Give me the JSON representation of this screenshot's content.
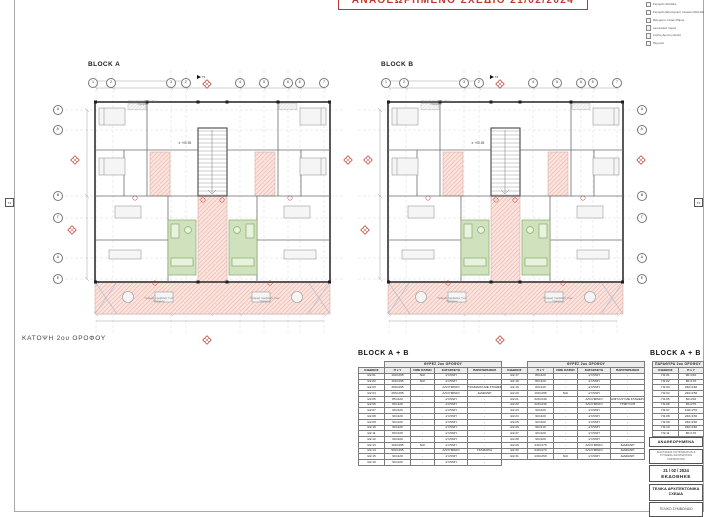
{
  "sheet": {
    "revision_banner": "ΑΝΑΘΕΩΡΗΜΕΝΟ ΣΧΕΔΙΟ 21/02/2024",
    "floor_plan_label": "ΚΑΤΟΨΗ 2ου ΟΡΟΦΟΥ"
  },
  "blocks": {
    "a": "BLOCK A",
    "b": "BLOCK B"
  },
  "legend": {
    "items": [
      "Κεραμίδι 40x40εκ.",
      "Κεραμίδι (Εξωτερικό) πλακάκι 60x120εκ.",
      "Μάρμαρο πλακέ 25ψηλ.",
      "Laminated παρκέ",
      "Ξύλινη Δρύινη (deck)",
      "Πέργολα"
    ]
  },
  "plan": {
    "top_bubbles": [
      "1",
      "2",
      "3",
      "2'",
      "4",
      "5",
      "6",
      "6'",
      "7"
    ],
    "row_bubbles": [
      "Α",
      "Α'",
      "Β",
      "Γ",
      "Δ",
      "Ε"
    ],
    "level_mark": "+05.55",
    "projection_note": "Γραμμή προβολής Των Ορόφων",
    "section_t1": "Τ1",
    "section_t2": "Τ2"
  },
  "doors_table": {
    "title": "BLOCK  A + B",
    "group_header": "ΘΥΡΕΣ 2ου ΟΡΟΦΟΥ",
    "columns": [
      "ΚΩΔΙΚΟΣ",
      "Π x Y",
      "FIRE RATED",
      "ΚΑΤΑΣΚΕΥΗ",
      "ΠΑΡΑΤΗΡΗΣΕΙΣ"
    ],
    "left_rows": [
      [
        "Θ2.01",
        "100×295",
        "ΝΑΙ",
        "ΞΥΛΙΝΗ",
        "-"
      ],
      [
        "Θ2.02",
        "100×295",
        "ΝΑΙ",
        "ΞΥΛΙΝΗ",
        "-"
      ],
      [
        "Θ2.03",
        "450×295",
        "-",
        "ΑΛΟΥΜΙΝΙΟ",
        "ΤΖΑΜΑΡΙΑ ΜΕ ΣΤΑΘΕΡΟ ΤΖΑΜΙ"
      ],
      [
        "Θ2.04",
        "250×295",
        "-",
        "ΑΛΟΥΜΙΝΙΟ",
        "ΔΙΑΦΑΝΗ"
      ],
      [
        "Θ2.05",
        "85×220",
        "-",
        "ΞΥΛΙΝΗ",
        "-"
      ],
      [
        "Θ2.06",
        "80×220",
        "-",
        "ΞΥΛΙΝΗ",
        "-"
      ],
      [
        "Θ2.07",
        "90×220",
        "-",
        "ΞΥΛΙΝΗ",
        "-"
      ],
      [
        "Θ2.08",
        "90×220",
        "-",
        "ΞΥΛΙΝΗ",
        "-"
      ],
      [
        "Θ2.09",
        "90×220",
        "-",
        "ΞΥΛΙΝΗ",
        "-"
      ],
      [
        "Θ2.10",
        "90×220",
        "-",
        "ΞΥΛΙΝΗ",
        "-"
      ],
      [
        "Θ2.11",
        "80×220",
        "-",
        "ΞΥΛΙΝΗ",
        "-"
      ],
      [
        "Θ2.12",
        "90×220",
        "-",
        "ΞΥΛΙΝΗ",
        "-"
      ],
      [
        "Θ2.13",
        "100×295",
        "ΝΑΙ",
        "ΞΥΛΙΝΗ",
        "-"
      ],
      [
        "Θ2.14",
        "500×295",
        "-",
        "ΑΛΟΥΜΙΝΙΟ",
        "ΤΖΑΜΑΡΙΑ"
      ],
      [
        "Θ2.15",
        "90×220",
        "-",
        "ΞΥΛΙΝΗ",
        "-"
      ],
      [
        "Θ2.16",
        "90×220",
        "-",
        "ΞΥΛΙΝΗ",
        "-"
      ]
    ],
    "right_rows": [
      [
        "Θ2.17",
        "80×220",
        "-",
        "ΞΥΛΙΝΗ",
        "-"
      ],
      [
        "Θ2.18",
        "80×220",
        "-",
        "ΞΥΛΙΝΗ",
        "-"
      ],
      [
        "Θ2.19",
        "80×240",
        "-",
        "ΞΥΛΙΝΗ",
        "-"
      ],
      [
        "Θ2.20",
        "100×295",
        "ΝΑΙ",
        "ΞΥΛΙΝΗ",
        "-"
      ],
      [
        "Θ2.21",
        "220×240",
        "-",
        "ΑΛΟΥΜΙΝΙΟ",
        "ΔΙΦΥΛΛΗ ΜΕ ΣΤΑΘΕΡΟ ΤΖΑΜΙ"
      ],
      [
        "Θ2.22",
        "220×240",
        "-",
        "ΑΛΟΥΜΙΝΙΟ",
        "ΤΡΙΦΥΛΛΗ"
      ],
      [
        "Θ2.23",
        "90×220",
        "-",
        "ΞΥΛΙΝΗ",
        "-"
      ],
      [
        "Θ2.24",
        "90×220",
        "-",
        "ΞΥΛΙΝΗ",
        "-"
      ],
      [
        "Θ2.25",
        "90×220",
        "-",
        "ΞΥΛΙΝΗ",
        "-"
      ],
      [
        "Θ2.26",
        "90×210",
        "-",
        "ΞΥΛΙΝΗ",
        "-"
      ],
      [
        "Θ2.27",
        "90×220",
        "-",
        "ΞΥΛΙΝΗ",
        "-"
      ],
      [
        "Θ2.28",
        "90×220",
        "-",
        "ΞΥΛΙΝΗ",
        "-"
      ],
      [
        "Θ2.29",
        "240×270",
        "-",
        "ΑΛΟΥΜΙΝΙΟ",
        "ΔΙΑΦΑΝΗ"
      ],
      [
        "Θ2.30",
        "240×270",
        "-",
        "ΑΛΟΥΜΙΝΙΟ",
        "ΔΙΑΦΑΝΗ"
      ],
      [
        "Θ2.31",
        "130×250",
        "ΝΑΙ",
        "ΞΥΛΙΝΗ",
        "ΔΙΑΦΑΝΗ"
      ]
    ]
  },
  "windows_table": {
    "title": "BLOCK  A + B",
    "group_header": "ΠΑΡΑΘΥΡΑ 2ου ΟΡΟΦΟΥ",
    "columns": [
      "ΚΩΔΙΚΟΣ",
      "Π x Y"
    ],
    "rows": [
      [
        "Π2.01",
        "90×210"
      ],
      [
        "Π2.02",
        "80×170"
      ],
      [
        "Π2.03",
        "240×150"
      ],
      [
        "Π2.04",
        "240×150"
      ],
      [
        "Π2.05",
        "60×210"
      ],
      [
        "Π2.06",
        "60×270"
      ],
      [
        "Π2.07",
        "100×270"
      ],
      [
        "Π2.08",
        "240×150"
      ],
      [
        "Π2.09",
        "240×150"
      ],
      [
        "Π2.10",
        "240×150"
      ],
      [
        "Π2.11",
        "80×170"
      ]
    ]
  },
  "stamp": {
    "revised_label": "ΑΝΑΘΕΩΡΗΜΕΝΑ",
    "revision_note": "ΔΙΑΣΤΑΣΕΙΣ ΚΟΥΦΩΜΑΤΩΝ & ΣΥΝΘΕΣΗ ΕΣΩΤΕΡΙΚΩΝ ΧΩΡΙΣΜΑΤΩΝ",
    "date": "21 / 02 / 2024",
    "issued_label": "ΕΚΔΟΘΗΚΕ",
    "purpose": "ΤΕΛΙΚΑ ΑΡΧΙΤΕΚΤΟΝΙΚΑ ΣΧΕΔΙΑ",
    "contract": "ΤΕΛΙΚΟ ΣΥΜΒΟΛΑΙΟ"
  },
  "colors": {
    "accent_red": "#c0392b",
    "veranda_pink": "#f5d9d3",
    "bath_green": "#cfe2bd",
    "wall_dark": "#474747"
  }
}
